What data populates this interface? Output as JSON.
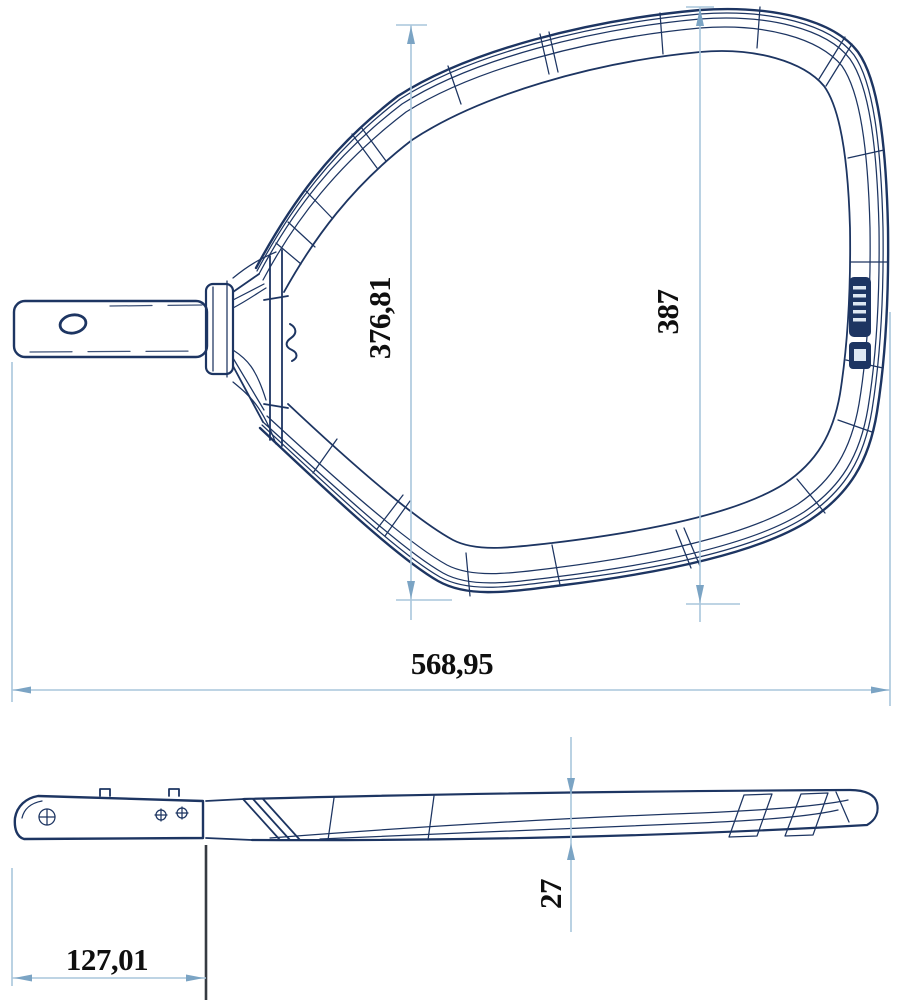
{
  "drawing_type": "technical-drawing",
  "colors": {
    "background": "#ffffff",
    "outline": "#1d3562",
    "dimension_line": "#a9c6dc",
    "dimension_arrow": "#7ba4c4",
    "dimension_text": "#0f0f0f",
    "dark_extension_line": "#363b42",
    "brand_badge": "#1d3562"
  },
  "dimensions": {
    "net_opening_height": "376,81",
    "frame_height": "387",
    "overall_length": "568,95",
    "handle_length": "127,01",
    "profile_thickness": "27"
  },
  "icons": {
    "brand_badge": "brand-badge",
    "logo_mark": "logo-mark",
    "screw_cross": "screw-cross-icon"
  }
}
